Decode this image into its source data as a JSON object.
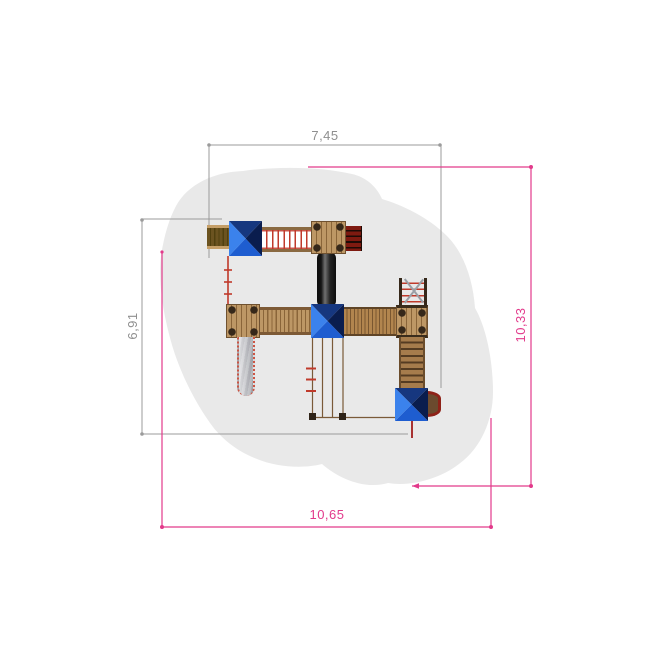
{
  "drawing": {
    "dimensions": {
      "top": "7,45",
      "left": "6,91",
      "right": "10,33",
      "bottom": "10,65"
    },
    "colors": {
      "dim_gray": "#9b9b9b",
      "dim_gray_text": "#8f8f8f",
      "dim_pink": "#e23a8b",
      "safety_zone": "#e9e9e9",
      "wood_light": "#bd9765",
      "wood_line": "#8a6539",
      "wood_edge": "#6f5130",
      "post_brown": "#36281a",
      "roof_top": "#16377f",
      "roof_right": "#0a1d4e",
      "roof_bottom": "#1e5dd0",
      "roof_left": "#3b82ec",
      "rung_red": "#c03a2b",
      "slat_red": "#7e1a10",
      "tube_black": "#141414",
      "slide_silver": "#c7c8cd",
      "stair_dark": "#553c22",
      "exit_red": "#8e2218"
    }
  }
}
